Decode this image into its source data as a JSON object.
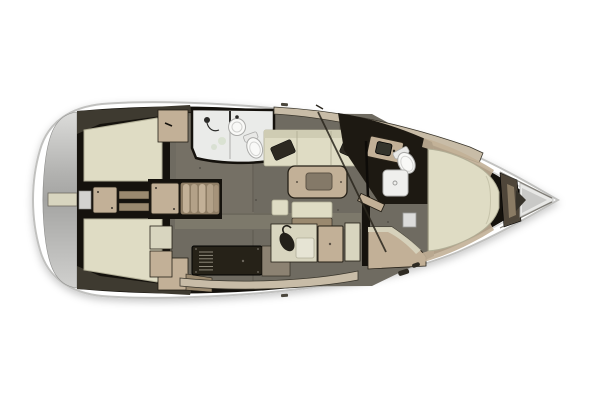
{
  "image": {
    "subject": "sailboat-interior-floor-plan",
    "view": "top-down"
  },
  "palette": {
    "background": "#ffffff",
    "hullFill": "#ffffff",
    "hullStroke": "#c1c1bf",
    "deckLine": "#d7d7d5",
    "transomLight": "#dcdcda",
    "transomMid": "#a6a6a4",
    "wall": "#15120d",
    "wallSoft": "#3e3a30",
    "floor": "#6f6b61",
    "floorLight": "#807b6d",
    "floorSeam": "#625e54",
    "cushion": "#dfdcc4",
    "cushionShade": "#cfccb3",
    "cushionEdge": "#b1ae96",
    "pillow": "#2d2921",
    "wood": "#c2b097",
    "woodDark": "#9a896f",
    "woodLight": "#d8d5bf",
    "shelf": "#c8bca7",
    "bath": "#eaebe9",
    "fixture": "#f9f9f7",
    "fixtureStroke": "#ababa9",
    "stove": "#262218",
    "stoveVent": "#8d887a",
    "headboard": "#4f463a",
    "headboardStripe": "#8a7b64",
    "outline": "#241f16",
    "bowLockerLight": "#e8e8e6",
    "bowLockerGray": "#c9c9c7"
  },
  "areas": [
    {
      "id": "transom-swim-platform"
    },
    {
      "id": "aft-cabin-port"
    },
    {
      "id": "aft-cabin-starboard"
    },
    {
      "id": "companionway-steps"
    },
    {
      "id": "aft-head-shower"
    },
    {
      "id": "galley"
    },
    {
      "id": "salon-settee-port"
    },
    {
      "id": "salon-table"
    },
    {
      "id": "salon-bench-starboard"
    },
    {
      "id": "forward-head"
    },
    {
      "id": "forward-cabin-vberth"
    },
    {
      "id": "bow-anchor-locker"
    }
  ]
}
